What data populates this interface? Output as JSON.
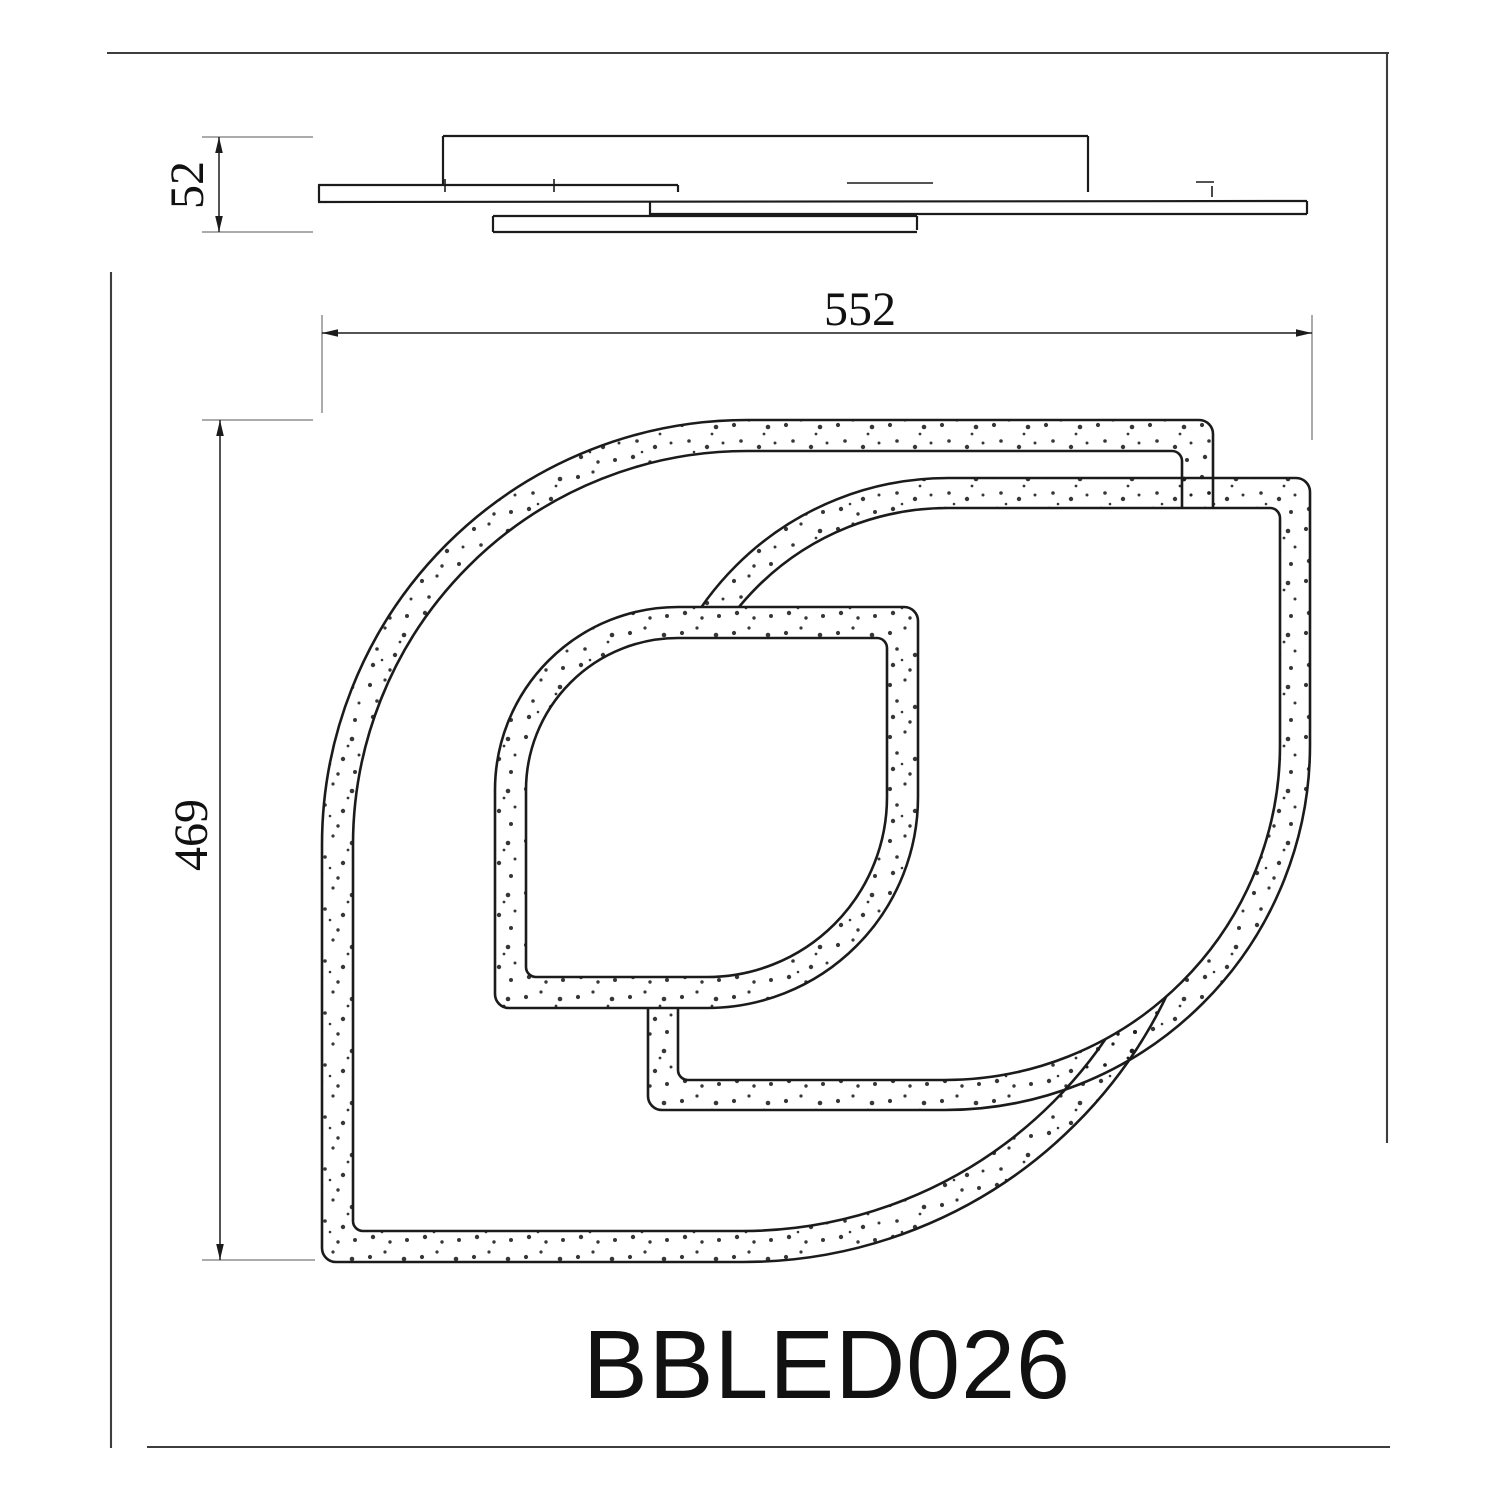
{
  "drawing": {
    "product_code": "BBLED026",
    "dimensions": {
      "fixture_height": "52",
      "fixture_width": "552",
      "fixture_depth": "469"
    },
    "colors": {
      "line": "#1b1b1b",
      "dim": "#8f8f8f",
      "frame": "#3d3d3d",
      "text": "#111111"
    }
  }
}
